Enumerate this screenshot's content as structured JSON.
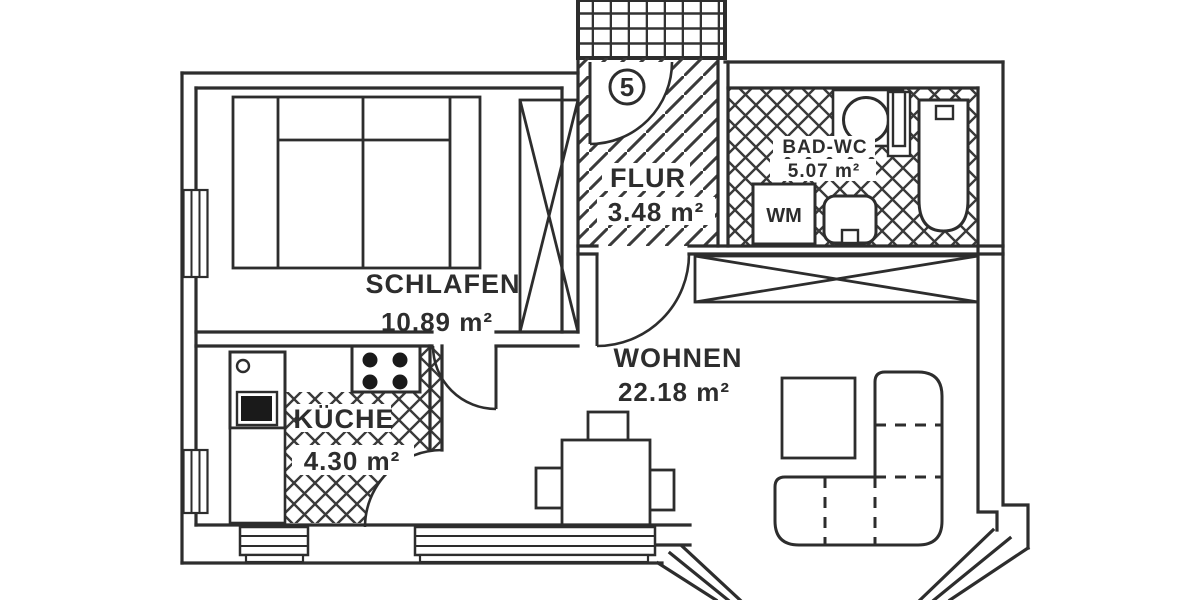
{
  "unit": {
    "number": "5"
  },
  "rooms": {
    "flur": {
      "name": "FLUR",
      "area": "3.48 m²"
    },
    "bad_wc": {
      "name": "BAD-WC",
      "area": "5.07 m²"
    },
    "schlafen": {
      "name": "SCHLAFEN",
      "area": "10.89 m²"
    },
    "kueche": {
      "name": "KÜCHE",
      "area": "4.30 m²"
    },
    "wohnen": {
      "name": "WOHNEN",
      "area": "22.18 m²"
    }
  },
  "fixtures": {
    "washing_machine_label": "WM"
  },
  "icons": [
    "bed",
    "wardrobe",
    "bathtub",
    "toilet",
    "washbasin",
    "radiator",
    "stove",
    "kitchen-sink",
    "dining-table",
    "chair",
    "sofa",
    "coffee-table",
    "door-swing",
    "window",
    "stair-grid"
  ],
  "colors": {
    "line": "#2d2d2d",
    "hatch": "#3a3a3a",
    "background": "#ffffff",
    "fill_dark": "#1a1a1a"
  }
}
